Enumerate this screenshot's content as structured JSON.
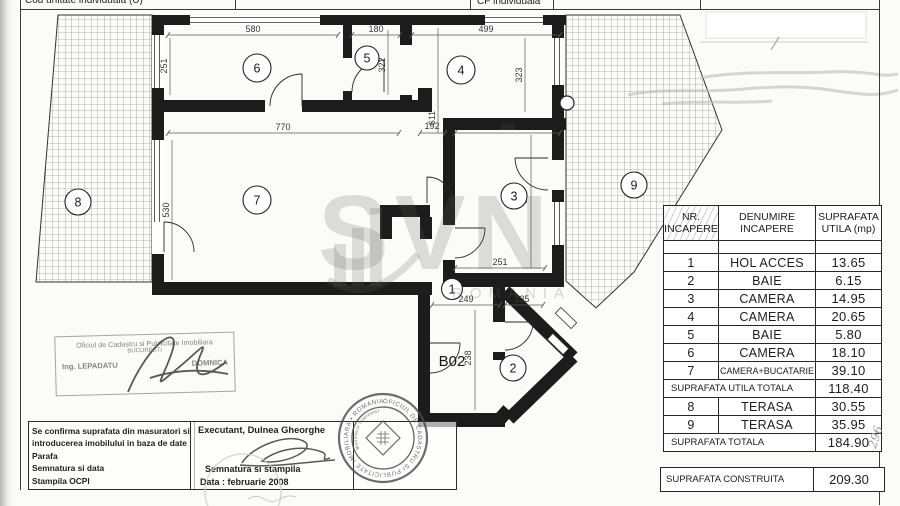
{
  "header": {
    "col1": "Cod unitate individuala (U)",
    "col2": "CF individuala"
  },
  "plan": {
    "unit_label": "B02",
    "rooms": [
      "1",
      "2",
      "3",
      "4",
      "5",
      "6",
      "7",
      "8",
      "9"
    ],
    "dims": {
      "room6_top": "580",
      "room6_left": "251",
      "room5_top": "180",
      "room5_right": "322",
      "room4_top": "499",
      "room4_right": "323",
      "overall_mid": "611",
      "room7_top": "770",
      "corridor": "192",
      "room3_top": "298",
      "room7_left": "530",
      "room3_right": "520",
      "room3_bottom": "251",
      "hall_top": "249",
      "hall_right": "135",
      "hall_left": "238"
    }
  },
  "watermark": {
    "text": "SVN",
    "subtext": "ROMANIA"
  },
  "table": {
    "header": {
      "col1_l1": "NR.",
      "col1_l2": "INCAPERE",
      "col2_l1": "DENUMIRE",
      "col2_l2": "INCAPERE",
      "col3_l1": "SUPRAFATA",
      "col3_l2": "UTILA (mp)"
    },
    "rows": [
      {
        "nr": "1",
        "name": "HOL ACCES",
        "area": "13.65"
      },
      {
        "nr": "2",
        "name": "BAIE",
        "area": "6.15"
      },
      {
        "nr": "3",
        "name": "CAMERA",
        "area": "14.95"
      },
      {
        "nr": "4",
        "name": "CAMERA",
        "area": "20.65"
      },
      {
        "nr": "5",
        "name": "BAIE",
        "area": "5.80"
      },
      {
        "nr": "6",
        "name": "CAMERA",
        "area": "18.10"
      },
      {
        "nr": "7",
        "name": "CAMERA+BUCATARIE",
        "area": "39.10"
      }
    ],
    "total_utila": {
      "label": "SUPRAFATA UTILA TOTALA",
      "value": "118.40"
    },
    "rows2": [
      {
        "nr": "8",
        "name": "TERASA",
        "area": "30.55"
      },
      {
        "nr": "9",
        "name": "TERASA",
        "area": "35.95"
      }
    ],
    "total": {
      "label": "SUPRAFATA TOTALA",
      "value": "184.90"
    },
    "construita": {
      "label": "SUPRAFATA CONSTRUITA",
      "value": "209.30"
    }
  },
  "confirm_box": {
    "line1": "Se confirma suprafata din masuratori si",
    "line2": "introducerea imobilului in baza de date",
    "line3": "Parafa",
    "line4": "Semnatura si data",
    "line5": "Stampila OCPI"
  },
  "executant_box": {
    "line1": "Executant, Dulnea  Gheorghe",
    "line2": "Semnatura si stampila",
    "line3": "Data :  februarie   2008"
  },
  "stamp_rect": {
    "line1": "Oficiul de Cadastru si Publicitate Imobiliara",
    "line2": "BUCURESTI",
    "name_left": "Ing. LEPADATU",
    "name_right": "DOMNICA"
  },
  "stamp_round": {
    "ring_text": "OFICIUL DE CADASTRU SI PUBLICITATE IMOBILIARA • ROMANIA •",
    "inner_text": "Ministerul Internelor"
  },
  "side_note": "296"
}
